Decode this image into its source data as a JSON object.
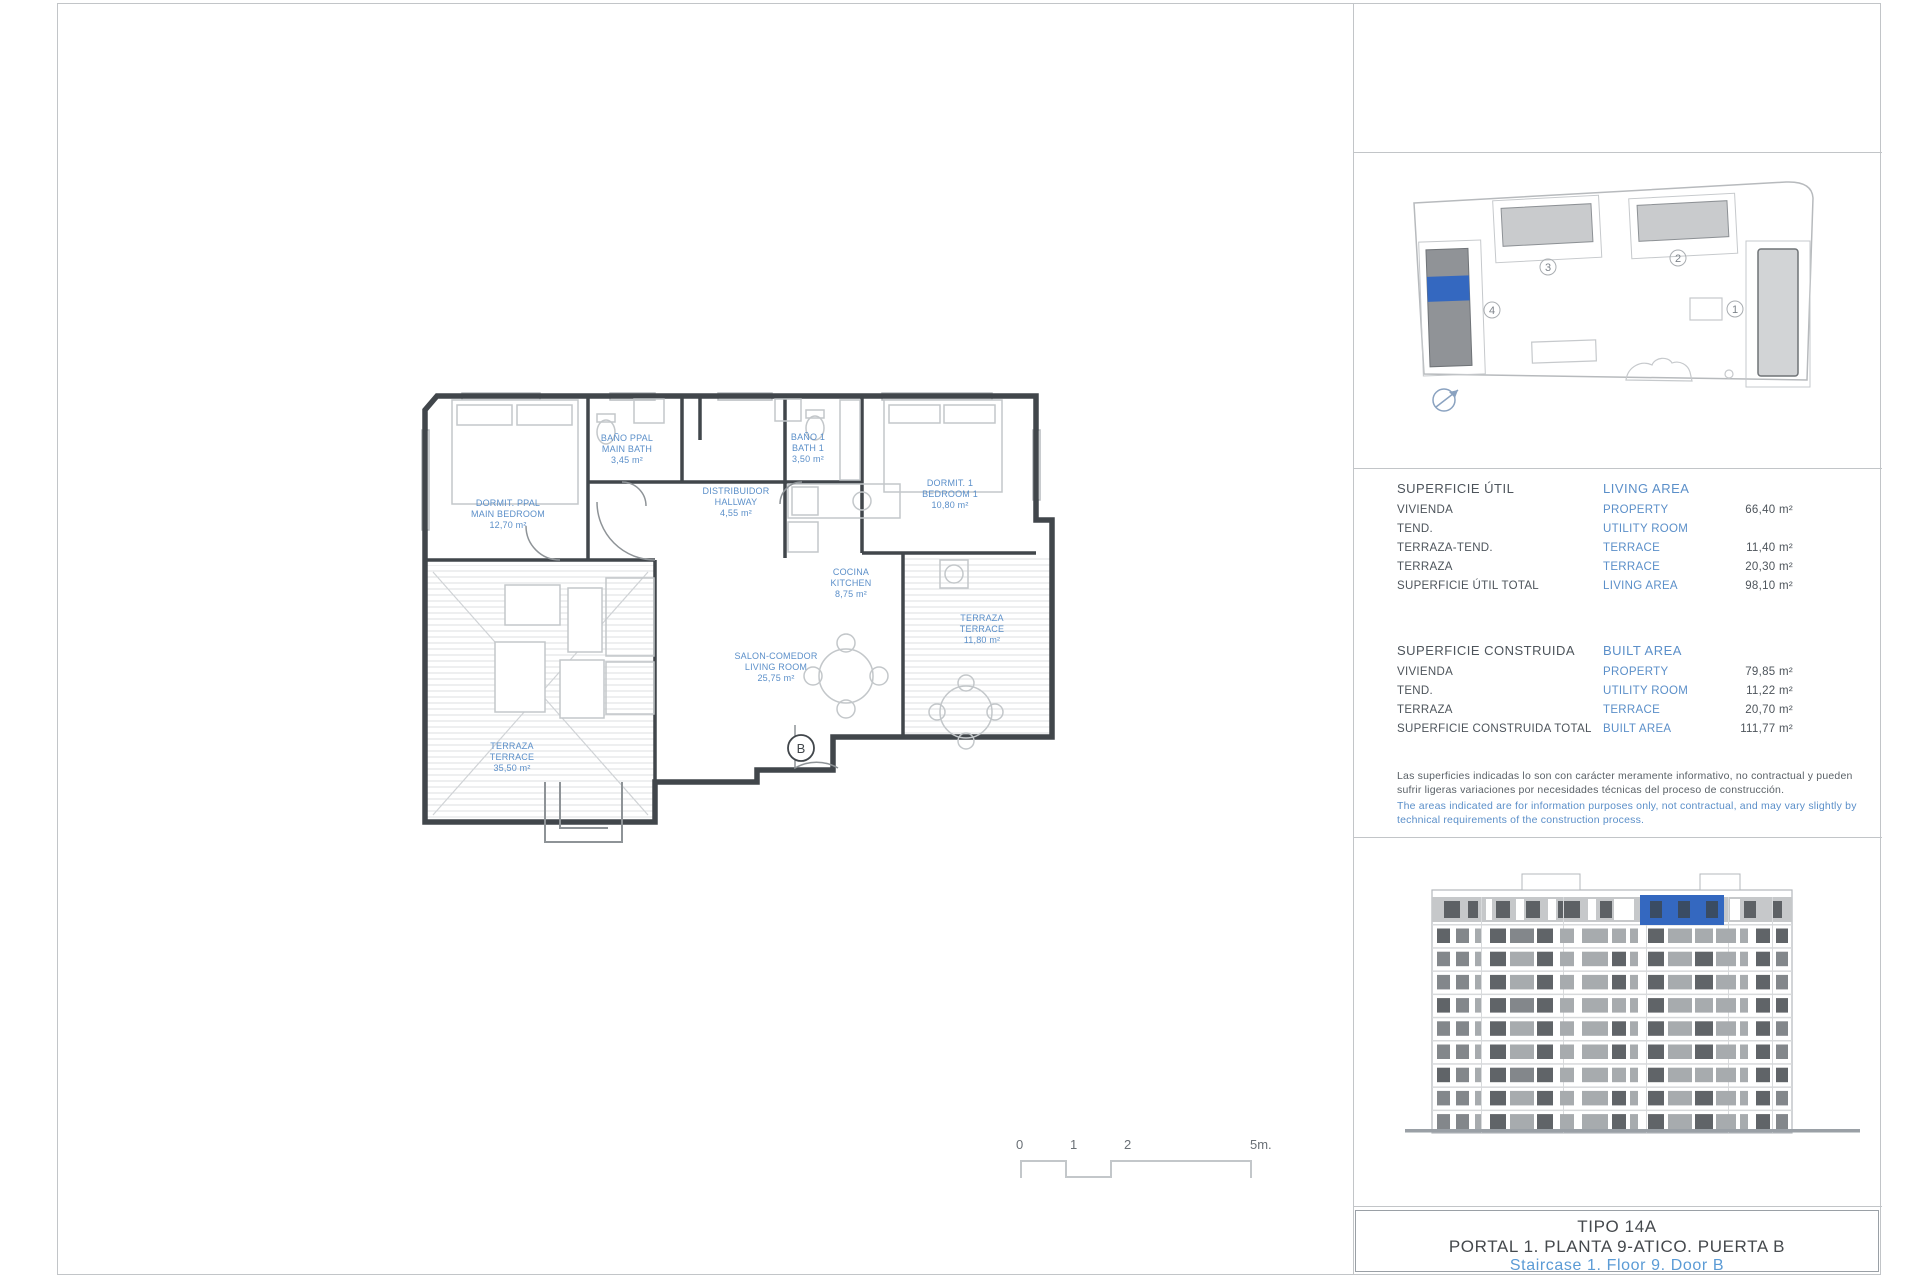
{
  "colors": {
    "accent_blue": "#5b8fc9",
    "highlight_blue": "#3468c0",
    "footer_blue": "#5b9bd5",
    "wall_dark": "#41464b"
  },
  "floor_plan": {
    "rooms": [
      {
        "es": "DORMIT. PPAL",
        "en": "MAIN BEDROOM",
        "area": "12,70 m²"
      },
      {
        "es": "BAÑO PPAL",
        "en": "MAIN BATH",
        "area": "3,45 m²"
      },
      {
        "es": "DISTRIBUIDOR",
        "en": "HALLWAY",
        "area": "4,55 m²"
      },
      {
        "es": "BAÑO 1",
        "en": "BATH 1",
        "area": "3,50 m²"
      },
      {
        "es": "DORMIT. 1",
        "en": "BEDROOM 1",
        "area": "10,80 m²"
      },
      {
        "es": "COCINA",
        "en": "KITCHEN",
        "area": "8,75 m²"
      },
      {
        "es": "SALON-COMEDOR",
        "en": "LIVING ROOM",
        "area": "25,75 m²"
      },
      {
        "es": "TERRAZA",
        "en": "TERRACE",
        "area": "11,80 m²"
      },
      {
        "es": "TERRAZA",
        "en": "TERRACE",
        "area": "35,50 m²"
      }
    ],
    "entrance_label": "B",
    "scale": {
      "t0": "0",
      "t1": "1",
      "t2": "2",
      "t5": "5m."
    }
  },
  "site_plan": {
    "labels": {
      "b1": "1",
      "b2": "2",
      "b3": "3",
      "b4": "4"
    }
  },
  "tables": {
    "living": {
      "title_es": "SUPERFICIE ÚTIL",
      "title_en": "LIVING AREA",
      "rows": [
        {
          "es": "VIVIENDA",
          "en": "PROPERTY",
          "value": "66,40 m²"
        },
        {
          "es": "TEND.",
          "en": "UTILITY ROOM",
          "value": ""
        },
        {
          "es": "TERRAZA-TEND.",
          "en": "TERRACE",
          "value": "11,40 m²"
        },
        {
          "es": "TERRAZA",
          "en": "TERRACE",
          "value": "20,30 m²"
        },
        {
          "es": "SUPERFICIE ÚTIL TOTAL",
          "en": "LIVING AREA",
          "value": "98,10 m²"
        }
      ]
    },
    "built": {
      "title_es": "SUPERFICIE CONSTRUIDA",
      "title_en": "BUILT AREA",
      "rows": [
        {
          "es": "VIVIENDA",
          "en": "PROPERTY",
          "value": "79,85 m²"
        },
        {
          "es": "TEND.",
          "en": "UTILITY ROOM",
          "value": "11,22 m²"
        },
        {
          "es": "TERRAZA",
          "en": "TERRACE",
          "value": "20,70 m²"
        },
        {
          "es": "SUPERFICIE CONSTRUIDA TOTAL",
          "en": "BUILT AREA",
          "value": "111,77 m²"
        }
      ]
    }
  },
  "disclaimer": {
    "es": "Las superficies indicadas lo son con carácter meramente informativo, no contractual y pueden sufrir ligeras variaciones por necesidades técnicas del proceso de construcción.",
    "en": "The areas indicated are for information purposes only, not contractual, and may vary slightly by technical requirements of the construction process."
  },
  "footer": {
    "line1": "TIPO 14A",
    "line2": "PORTAL 1. PLANTA 9-ATICO. PUERTA B",
    "line3": "Staircase 1. Floor 9. Door B"
  }
}
